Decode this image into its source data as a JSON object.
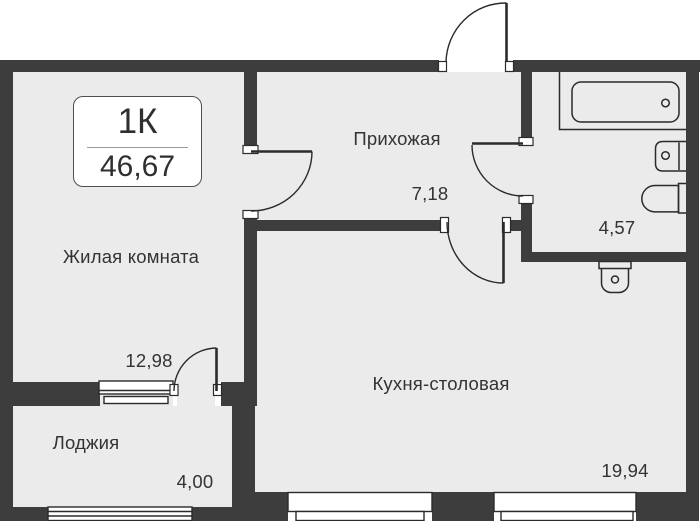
{
  "floorplan": {
    "badge": {
      "type_label": "1К",
      "total_area": "46,67"
    },
    "rooms": {
      "living": {
        "name": "Жилая комната",
        "area": "12,98"
      },
      "hallway": {
        "name": "Прихожая",
        "area": "7,18"
      },
      "kitchen": {
        "name": "Кухня-столовая",
        "area": "19,94"
      },
      "loggia": {
        "name": "Лоджия",
        "area": "4,00"
      },
      "bathroom": {
        "area": "4,57"
      }
    },
    "fixtures": [
      "bathtub",
      "bathroom-sink",
      "toilet",
      "kitchen-sink"
    ],
    "colors": {
      "wall": "#3d3d3d",
      "floor": "#ebebeb",
      "line": "#2b2b2b",
      "text": "#333333",
      "background": "#ffffff"
    }
  }
}
